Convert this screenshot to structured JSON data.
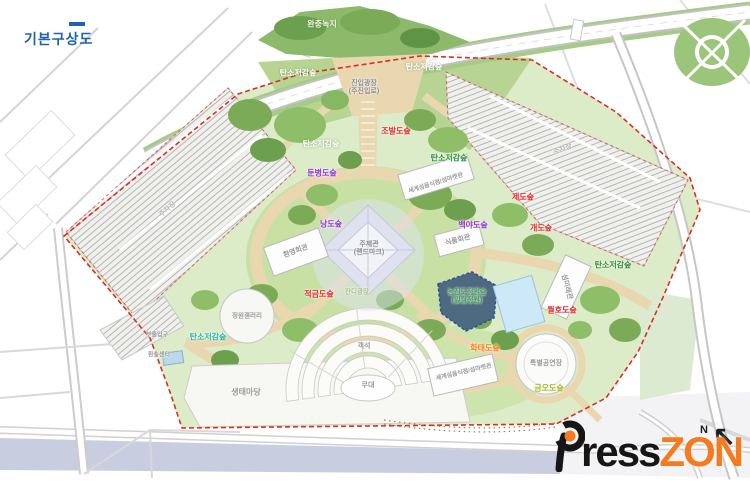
{
  "page": {
    "title": "기본구상도"
  },
  "colors": {
    "title_blue": "#1e63b0",
    "frame_pink": "#ecc2c2",
    "boundary_red": "#d93025",
    "path_tan": "#e9d7b0",
    "site_green": "#dcebc8",
    "water_lavender": "#c9cde0",
    "logo_orange": "#f47b20",
    "logo_black": "#161616",
    "label_red": "#e02a2a",
    "label_purple": "#8d33d6",
    "label_green": "#2f8f3c",
    "label_teal": "#27b5b0",
    "label_orange": "#f5820b",
    "label_yellow_green": "#aab61e"
  },
  "watermark": {
    "p": "P",
    "rest": "ress",
    "zon": "ZON"
  },
  "compass": {
    "label": "N"
  },
  "map": {
    "labels": [
      {
        "name": "zone-buffer-green",
        "text": "완충녹지",
        "x": 322,
        "y": 24,
        "color": "#eef7e4",
        "size": 8,
        "cls": "white"
      },
      {
        "name": "plaza-main-entrance",
        "text": "진입광장\n(주진입로)",
        "x": 364,
        "y": 88,
        "color": "#8a8a8a",
        "size": 7
      },
      {
        "name": "zone-carbon-forest-nw",
        "text": "탄소저감숲",
        "x": 298,
        "y": 73,
        "color": "#ffffff",
        "size": 8,
        "cls": "white"
      },
      {
        "name": "zone-carbon-forest-ne",
        "text": "탄소저감숲",
        "x": 424,
        "y": 67,
        "color": "#ffffff",
        "size": 8,
        "cls": "white"
      },
      {
        "name": "zone-carbon-forest-mid",
        "text": "탄소저감숲",
        "x": 321,
        "y": 144,
        "color": "#ffffff",
        "size": 8,
        "cls": "white"
      },
      {
        "name": "zone-jobaldo-forest",
        "text": "조발도숲",
        "x": 396,
        "y": 131,
        "color": "#e02a2a",
        "size": 8
      },
      {
        "name": "zone-carbon-forest-east-upper",
        "text": "탄소저감숲",
        "x": 449,
        "y": 158,
        "color": "#2f8f3c",
        "size": 8
      },
      {
        "name": "zone-dunbyeongdo-forest",
        "text": "둔병도숲",
        "x": 322,
        "y": 173,
        "color": "#8d33d6",
        "size": 8
      },
      {
        "name": "zone-jedo-forest",
        "text": "제도숲",
        "x": 523,
        "y": 197,
        "color": "#e02a2a",
        "size": 8
      },
      {
        "name": "zone-gaedo-forest",
        "text": "개도숲",
        "x": 541,
        "y": 228,
        "color": "#e02a2a",
        "size": 8
      },
      {
        "name": "zone-nangdo-forest",
        "text": "낭도숲",
        "x": 331,
        "y": 224,
        "color": "#8d33d6",
        "size": 8
      },
      {
        "name": "zone-baekyado-forest",
        "text": "백야도숲",
        "x": 473,
        "y": 225,
        "color": "#8d33d6",
        "size": 8
      },
      {
        "name": "facility-welcome-hall",
        "text": "환영회관",
        "x": 296,
        "y": 252,
        "color": "#9a9a9a",
        "size": 7,
        "rot": -20
      },
      {
        "name": "facility-theme-pavilion",
        "text": "주제관\n(랜드마크)",
        "x": 369,
        "y": 249,
        "color": "#8a8a8a",
        "size": 7
      },
      {
        "name": "facility-world-island-food-market-upper",
        "text": "세계섬음식점/섬마켓관",
        "x": 436,
        "y": 184,
        "color": "#9a9a9a",
        "size": 6,
        "rot": -17
      },
      {
        "name": "facility-food-hall",
        "text": "식품회관",
        "x": 458,
        "y": 241,
        "color": "#9a9a9a",
        "size": 7,
        "rot": -15
      },
      {
        "name": "zone-carbon-forest-east-lower",
        "text": "탄소저감숲",
        "x": 613,
        "y": 265,
        "color": "#2f8f3c",
        "size": 8
      },
      {
        "name": "facility-island-future-hall",
        "text": "섬미래관",
        "x": 566,
        "y": 287,
        "color": "#9a9a9a",
        "size": 7,
        "rot": 75
      },
      {
        "name": "zone-jeokgeumdo-forest",
        "text": "적금도숲",
        "x": 319,
        "y": 294,
        "color": "#e02a2a",
        "size": 8
      },
      {
        "name": "zone-island-garden-forest",
        "text": "농진도정원숲\n(일월정원)",
        "x": 467,
        "y": 297,
        "color": "#3aa04a",
        "size": 7
      },
      {
        "name": "zone-wolhodo-forest",
        "text": "월호도숲",
        "x": 562,
        "y": 310,
        "color": "#e02a2a",
        "size": 8
      },
      {
        "name": "zone-hwataedo-forest",
        "text": "화태도숲",
        "x": 485,
        "y": 348,
        "color": "#f5820b",
        "size": 8
      },
      {
        "name": "zone-geumodo-forest",
        "text": "금오도숲",
        "x": 549,
        "y": 388,
        "color": "#aab61e",
        "size": 8
      },
      {
        "name": "zone-carbon-forest-sw",
        "text": "탄소저감숲",
        "x": 208,
        "y": 337,
        "color": "#27b5b0",
        "size": 8
      },
      {
        "name": "facility-garden-gallery",
        "text": "정원갤러리",
        "x": 247,
        "y": 316,
        "color": "#9a9a9a",
        "size": 6.5
      },
      {
        "name": "facility-special-stage",
        "text": "특별공연장",
        "x": 546,
        "y": 364,
        "color": "#9a9a9a",
        "size": 7
      },
      {
        "name": "facility-world-island-food-market-lower",
        "text": "세계섬음식점/섬마켓관",
        "x": 464,
        "y": 373,
        "color": "#9a9a9a",
        "size": 6,
        "rot": -13
      },
      {
        "name": "facility-stage",
        "text": "무대",
        "x": 368,
        "y": 386,
        "color": "#9a9a9a",
        "size": 7
      },
      {
        "name": "facility-seating",
        "text": "객석",
        "x": 364,
        "y": 347,
        "color": "#9a9a9a",
        "size": 7
      },
      {
        "name": "area-lawn-plaza",
        "text": "잔디광장",
        "x": 357,
        "y": 292,
        "color": "#a9bd8a",
        "size": 6.5
      },
      {
        "name": "area-eco-plaza",
        "text": "생태마당",
        "x": 246,
        "y": 392,
        "color": "#9a9a9a",
        "size": 8
      },
      {
        "name": "gate-sub-entrance",
        "text": "부출입구",
        "x": 157,
        "y": 336,
        "color": "#9a9a9a",
        "size": 6
      },
      {
        "name": "facility-transfer-center",
        "text": "환승센터",
        "x": 159,
        "y": 356,
        "color": "#9a9a9a",
        "size": 6
      },
      {
        "name": "area-parking-west",
        "text": "주차장",
        "x": 168,
        "y": 210,
        "color": "#b5b5b5",
        "size": 7,
        "rot": -40
      },
      {
        "name": "area-parking-east",
        "text": "주차장",
        "x": 563,
        "y": 150,
        "color": "#b5b5b5",
        "size": 7,
        "rot": -20
      }
    ]
  }
}
